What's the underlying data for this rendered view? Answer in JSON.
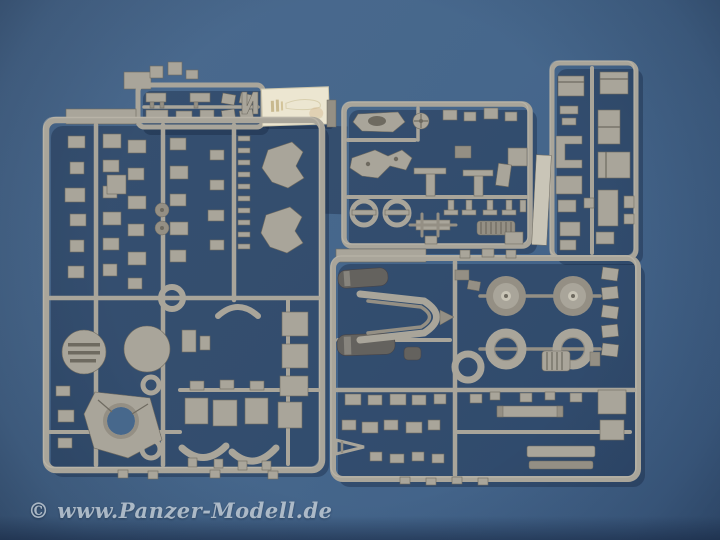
{
  "image_type": "photograph",
  "subject": "Gray plastic scale-model kit sprues (parts frames) with a small cream decal sheet, photographed on a blue surface",
  "watermark": {
    "text": "© www.Panzer-Modell.de"
  },
  "colors": {
    "bg_blue": "#4b6a8e",
    "bg_blue_mid": "#44648a",
    "bg_blue_dark": "#3a567a",
    "shadow_navy": "#16263e",
    "plastic": "#a9a59a",
    "plastic_light": "#c9c5b7",
    "plastic_mid": "#948f84",
    "plastic_dark": "#6e6a60",
    "dark_part": "#64625e",
    "decal_cream": "#ece6d1",
    "watermark_color": "#c3cdd6"
  },
  "objects": {
    "top_small_sprue": "small parts sprue, top left of center",
    "decal_sheet": "cream decal/marking sheet",
    "left_large_sprue": "large sprue with discs and carriage ring",
    "middle_upper_sprue": "sprue with gun carriage parts and spring",
    "right_tall_sprue": "narrow vertical sprue with ammo boxes",
    "bottom_right_large_sprue": "large sprue with road wheels and tires",
    "flat_strip_part": "loose flat plastic strip"
  }
}
